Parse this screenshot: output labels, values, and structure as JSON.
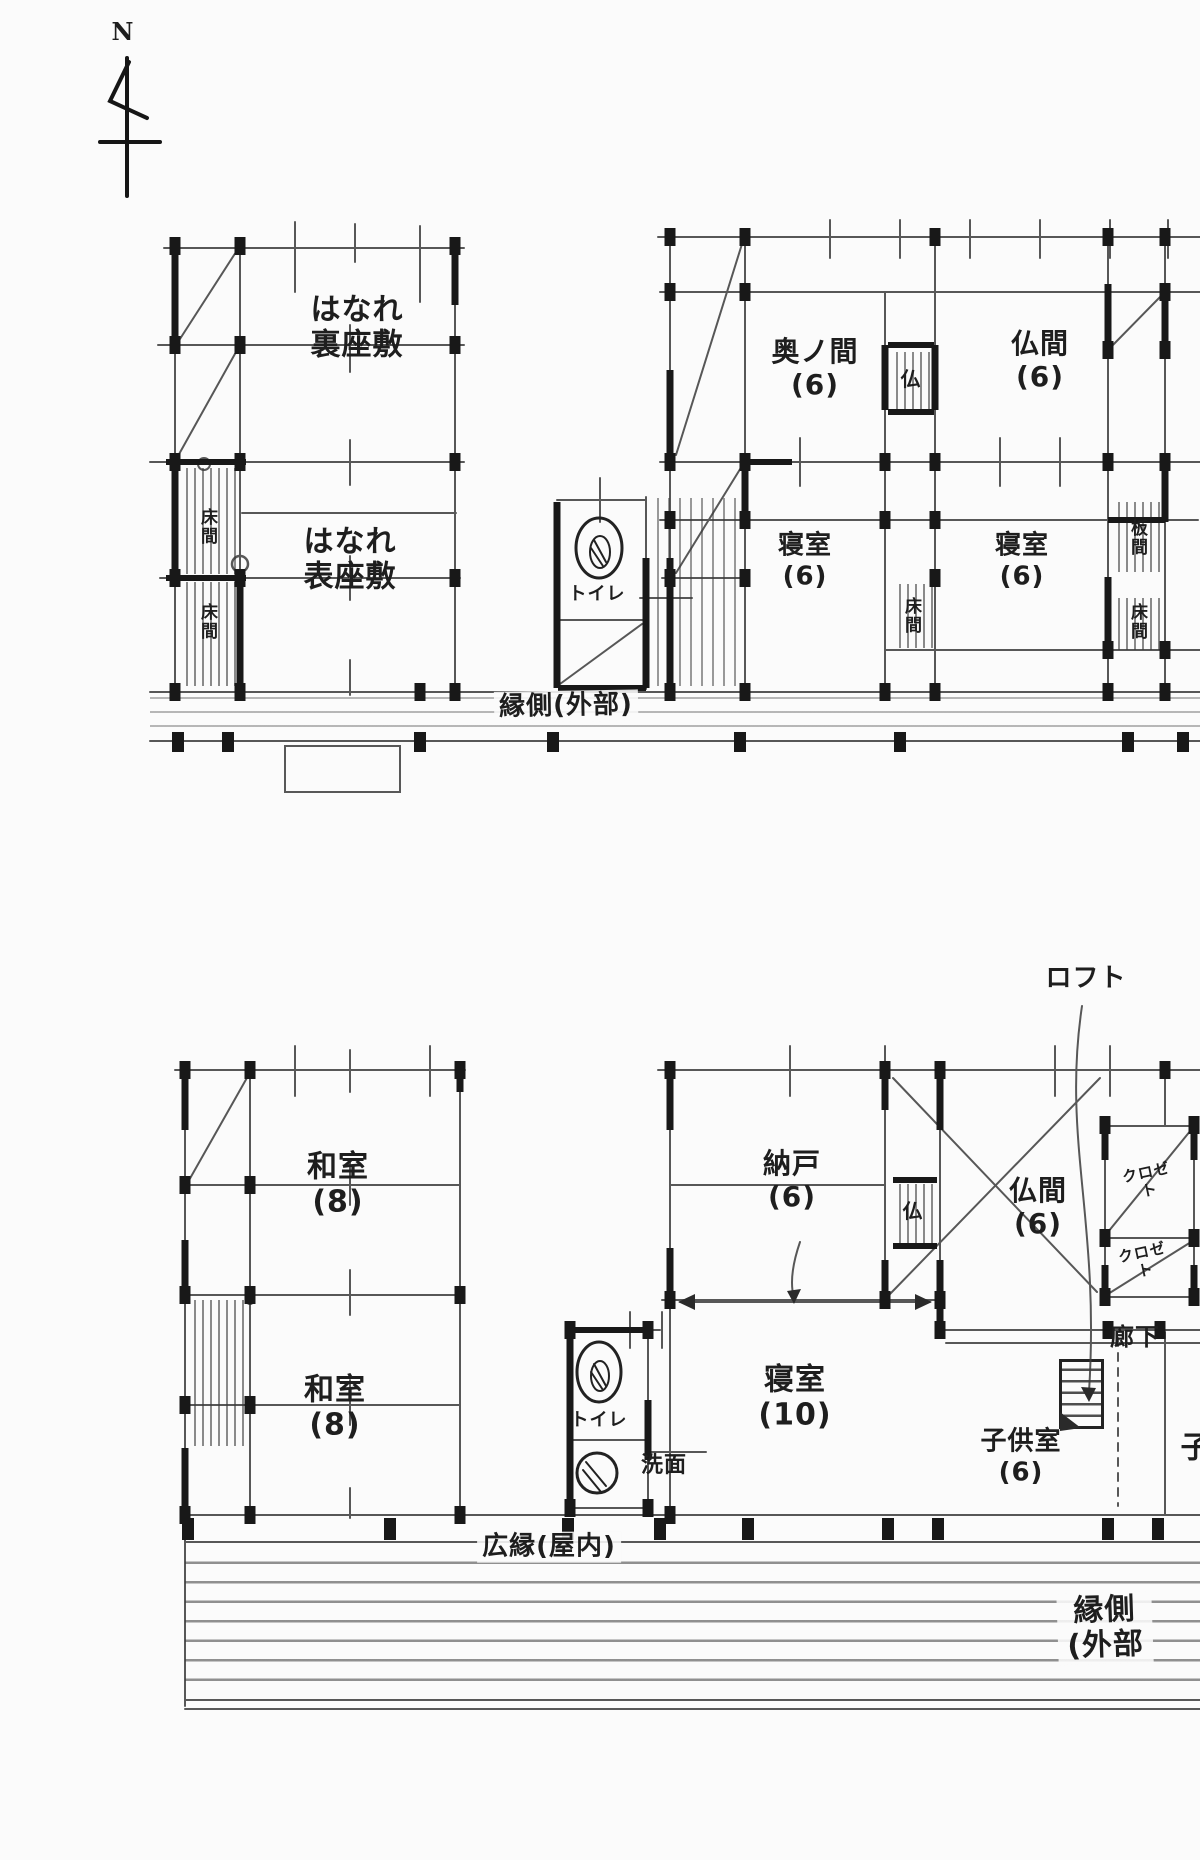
{
  "compass": {
    "north_label": "N"
  },
  "upper_plan": {
    "rooms": {
      "hanare_ura_zashiki": "はなれ\n裏座敷",
      "hanare_omote_zashiki": "はなれ\n表座敷",
      "oku_no_ma": "奥ノ間\n(6)",
      "butsuma": "仏間\n(6)",
      "butsudan": "仏",
      "shinshitsu_left": "寝室\n(6)",
      "shinshitsu_right": "寝室\n(6)",
      "toilet": "トイレ",
      "tokonoma_left_upper": "床間",
      "tokonoma_left_lower": "床間",
      "tokonoma_center": "床間",
      "itanoma": "板間",
      "tokonoma_right": "床間",
      "engawa": "縁側(外部)"
    }
  },
  "lower_plan": {
    "rooms": {
      "loft": "ロフト",
      "washitsu_upper": "和室\n(8)",
      "washitsu_lower": "和室\n(8)",
      "nando": "納戸\n(6)",
      "butsuma": "仏間\n(6)",
      "butsudan": "仏",
      "closet_upper": "クロゼト",
      "closet_lower": "クロゼト",
      "shinshitsu": "寝室\n(10)",
      "kodomo_shitsu": "子供室\n(6)",
      "rouka": "廊下",
      "toilet": "トイレ",
      "senmen": "洗面",
      "hiroen": "広縁(屋内)",
      "engawa": "縁側(外部",
      "partial_room": "子"
    }
  }
}
